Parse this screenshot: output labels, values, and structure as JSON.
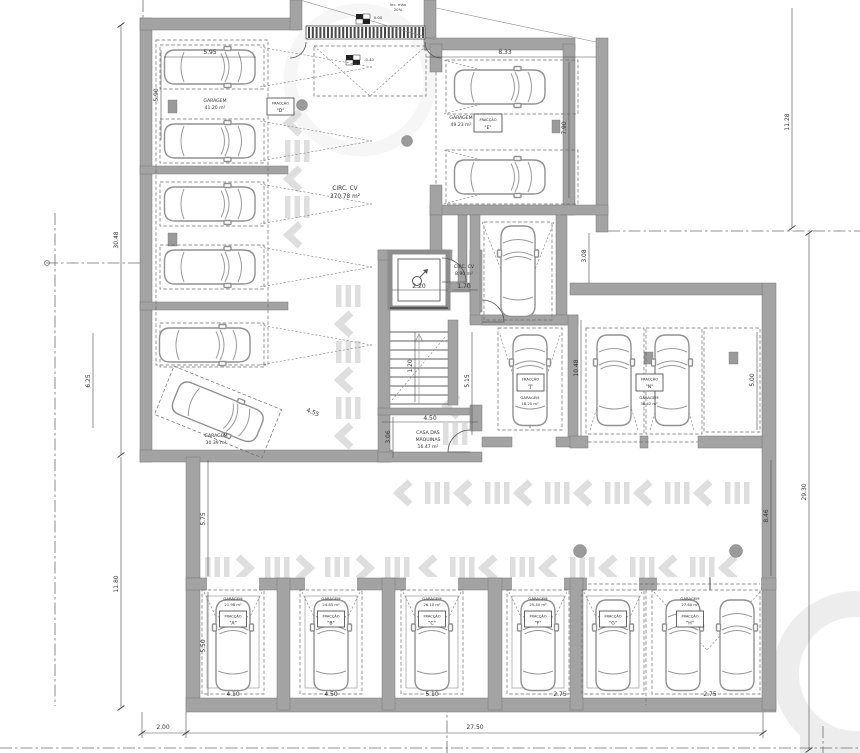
{
  "plan": {
    "rooms": {
      "circ_main": {
        "name": "CIRC. CV",
        "area": "370.78 m²"
      },
      "circ_core": {
        "name": "CIRC. CV",
        "area": "8.90 m²"
      },
      "garage_d": {
        "name": "GARAGEM",
        "area": "41.20 m²"
      },
      "garage_e": {
        "name": "GARAGEM",
        "area": "49.23 m²"
      },
      "garage_diag": {
        "name": "GARAGEM",
        "area": "30.39 m²"
      },
      "machine_room": {
        "line1": "CASA DAS",
        "line2": "MÁQUINAS",
        "area": "16.47 m²"
      },
      "garage_j": {
        "name": "GARAGEM",
        "area": "18.25 m²"
      },
      "garage_n": {
        "name": "GARAGEM",
        "area": "36.42 m²"
      },
      "bay1": {
        "name": "GARAGEM",
        "area": "21.98 m²"
      },
      "bay2": {
        "name": "GARAGEM",
        "area": "24.85 m²"
      },
      "bay3": {
        "name": "GARAGEM",
        "area": "26.10 m²"
      },
      "bay4": {
        "name": "GARAGEM",
        "area": "25.40 m²"
      },
      "bay6": {
        "name": "GARAGEM",
        "area": "27.60 m²"
      }
    },
    "fractions": {
      "label": "FRACÇÃO",
      "d": "\"D\"",
      "e": "\"E\"",
      "j": "\"J\"",
      "n": "\"N\"",
      "a": "\"A\"",
      "b": "\"B\"",
      "c": "\"C\"",
      "f": "\"F\"",
      "g": "\"G\"",
      "h": "\"H\""
    },
    "levels": {
      "street": "0.00",
      "ramp": "-0.40"
    },
    "ramp_note": {
      "line1": "inc. máx",
      "line2": "20%"
    },
    "dims": {
      "top_car": "5.95",
      "top_e": "8.33",
      "left_wall": "5.90",
      "left_upper": "30.48",
      "left_lower": "11.80",
      "diag_h": "6.25",
      "diag_w": "4.55",
      "aisle_left_h": "5.75",
      "bottom_left_h": "5.50",
      "setback": "2.00",
      "bottom_total": "27.50",
      "bay1_w": "4.10",
      "bay2_w": "4.50",
      "bay3_w": "5.10",
      "bay4_w": "2.75",
      "bay6_w": "2.75",
      "right_top": "11.28",
      "right_total": "29.30",
      "e_right": "7.90",
      "n_block_h": "10.48",
      "n_gap": "3.08",
      "n_bay": "5.00",
      "aisle_right_h": "8.46",
      "elev_w": "2.20",
      "lobby_w": "1.70",
      "stair_w": "1.20",
      "stair_h": "5.15",
      "machine_w": "4.50",
      "machine_h": "3.06"
    }
  }
}
